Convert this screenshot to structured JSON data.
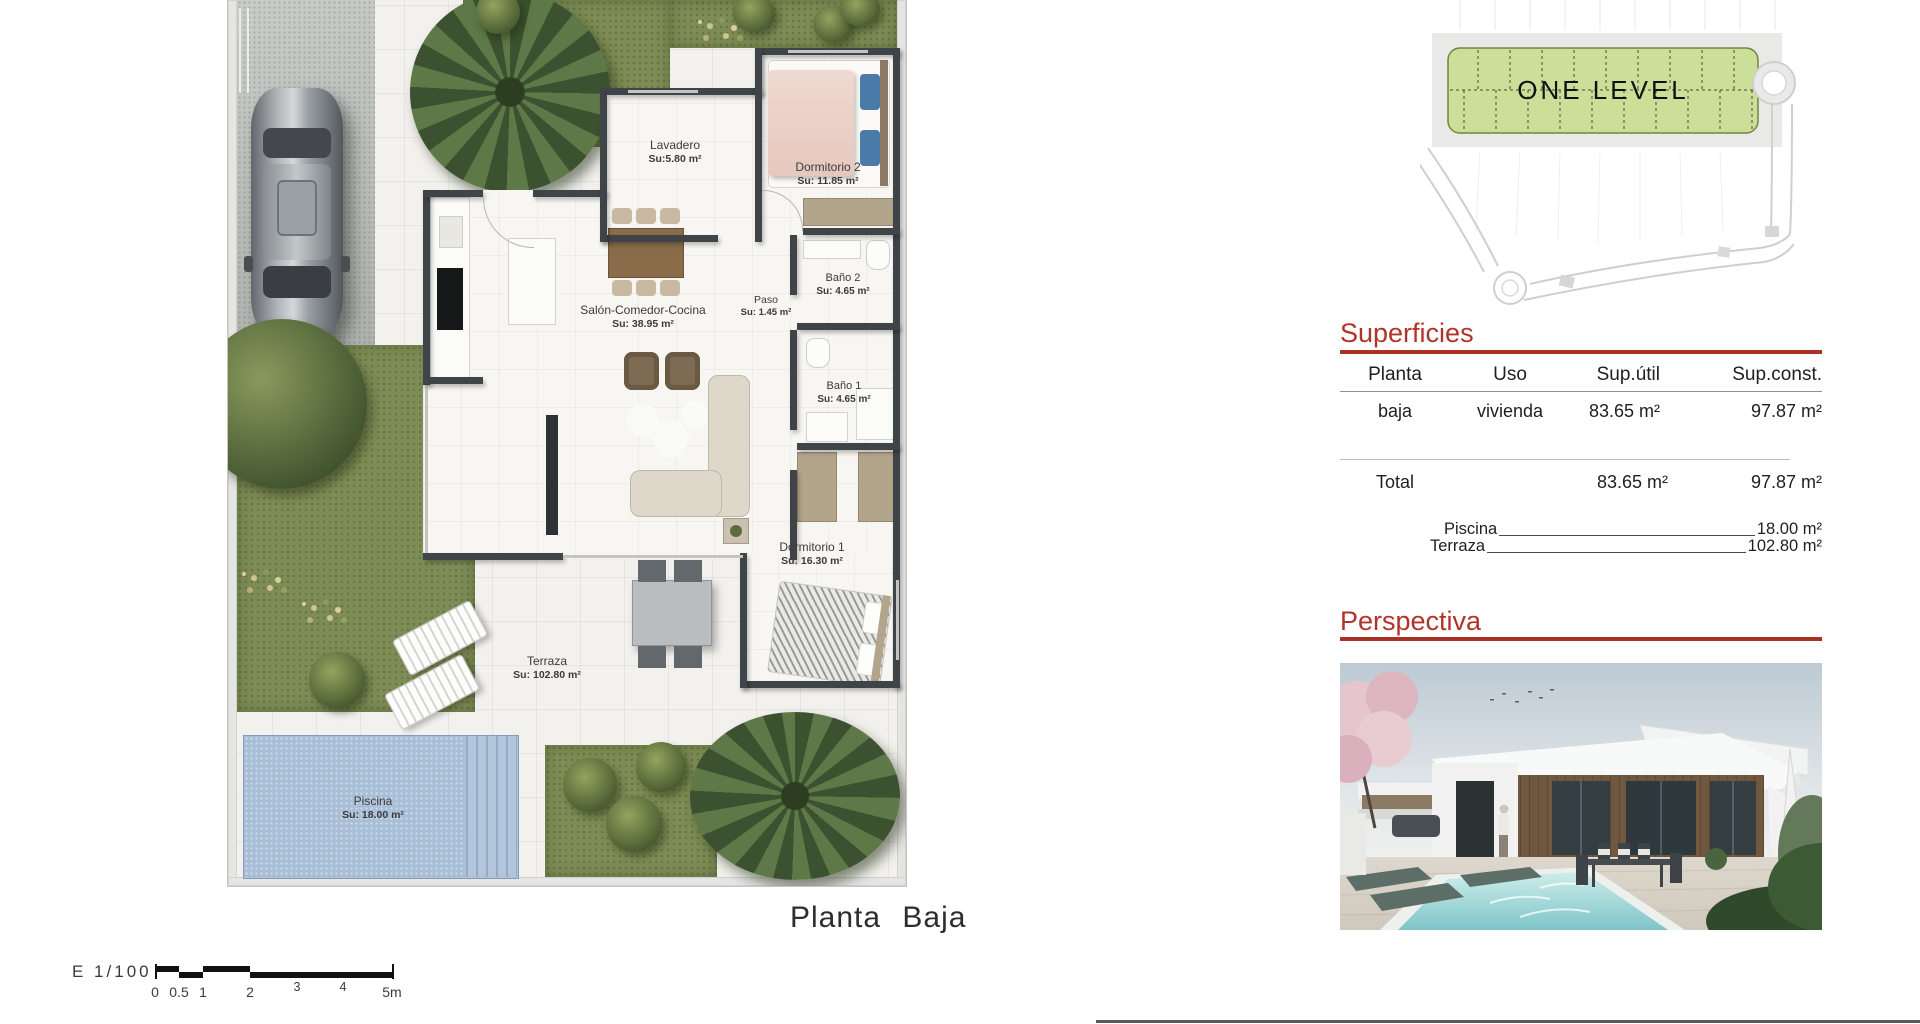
{
  "floor_plan": {
    "title": "Planta Baja",
    "scale_label": "E 1/100",
    "scale_ticks": [
      "0",
      "0.5",
      "1",
      "2",
      "3",
      "4",
      "5m"
    ],
    "rooms": [
      {
        "name": "Lavadero",
        "area": "Su:5.80 m²"
      },
      {
        "name": "Dormitorio 2",
        "area": "Su: 11.85 m²"
      },
      {
        "name": "Salón-Comedor-Cocina",
        "area": "Su: 38.95 m²"
      },
      {
        "name": "Paso",
        "area": "Su: 1.45 m²"
      },
      {
        "name": "Baño 2",
        "area": "Su: 4.65 m²"
      },
      {
        "name": "Baño 1",
        "area": "Su: 4.65 m²"
      },
      {
        "name": "Dormitorio 1",
        "area": "Su: 16.30 m²"
      },
      {
        "name": "Terraza",
        "area": "Su: 102.80 m²"
      },
      {
        "name": "Piscina",
        "area": "Su: 18.00 m²"
      }
    ]
  },
  "site_plan": {
    "label": "ONE LEVEL"
  },
  "superficies": {
    "heading": "Superficies",
    "columns": [
      "Planta",
      "Uso",
      "Sup.útil",
      "Sup.const."
    ],
    "row": {
      "planta": "baja",
      "uso": "vivienda",
      "util": "83.65 m²",
      "construida": "97.87 m²"
    },
    "total": {
      "label": "Total",
      "util": "83.65 m²",
      "construida": "97.87 m²"
    },
    "extras": [
      {
        "label": "Piscina",
        "value": "18.00 m²"
      },
      {
        "label": "Terraza",
        "value": "102.80 m²"
      }
    ]
  },
  "perspectiva": {
    "heading": "Perspectiva"
  },
  "colors": {
    "accent_red": "#b13428",
    "site_green": "#ccdf98",
    "pool_blue": "#a9bfd7",
    "wall_dark": "#3f4448",
    "grass_green": "#7e8d56"
  }
}
